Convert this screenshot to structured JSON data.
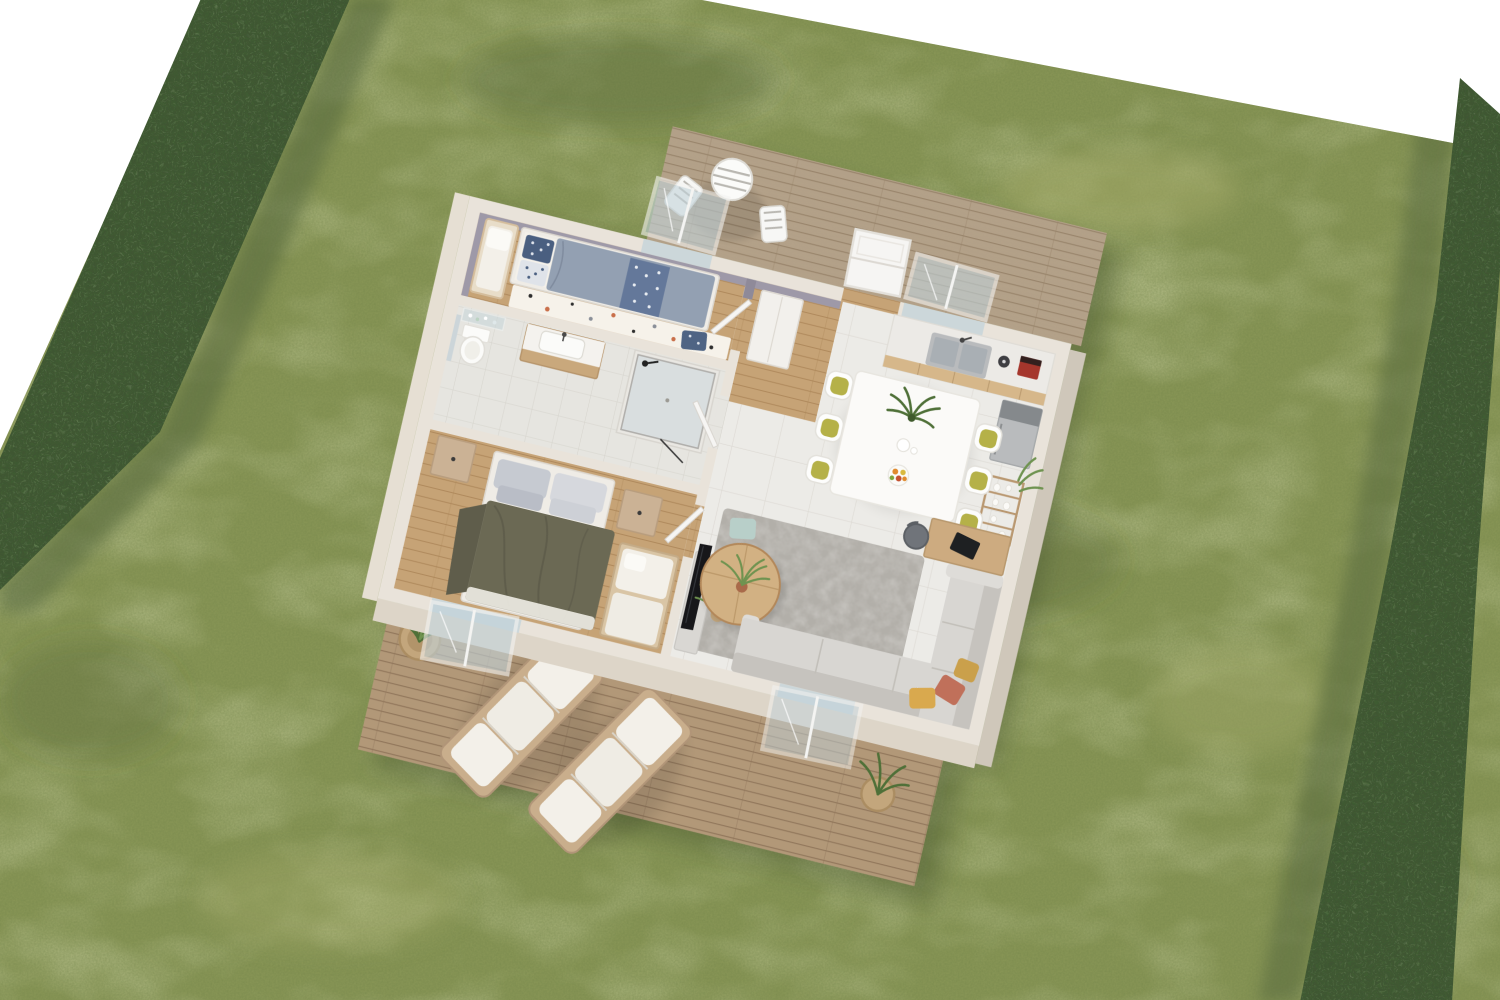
{
  "scene": {
    "title": "3D aerial cutaway floor plan of a small one-storey house",
    "view": "isometric top-down architectural render, no roof",
    "setting": "rectangular mowed lawn bordered by tall clipped hedges on a white studio background"
  },
  "colors": {
    "background": "#ffffff",
    "grass": "#8a9757",
    "grass_light": "#aab573",
    "grass_dark": "#3f5030",
    "hedge": "#3f5334",
    "hedge_dark": "#22301a",
    "hedge_light": "#5d7747",
    "deck_upper": "#b3a189",
    "deck_upper_gap": "#97836a",
    "deck_lower": "#b29878",
    "deck_lower_gap": "#8f7459",
    "wood_floor": "#c6a376",
    "wood_floor_gap": "#aa8557",
    "tile": "#ecebe7",
    "tile_line": "#dcd9d3",
    "bath_tile": "#e6e5e0",
    "bath_tile_line": "#d5d3cc",
    "wall_top": "#e9e3da",
    "wall_face": "#ddd5c8",
    "wall_face_dark": "#cfc7ba",
    "accent_wall": "#9e99a8",
    "accent_wall_dark": "#8f8a99",
    "bed_frame": "#efece6",
    "duvet_single": "#93a0b2",
    "pillow_navy": "#4a5f80",
    "duvet_master": "#6b6954",
    "duvet_master_dark": "#5f5d4b",
    "nightstand": "#cbb295",
    "bench_wood": "#d9c5a5",
    "cushion_white": "#f3f0e9",
    "rug_bedroom": "#f6f2ea",
    "rug_living": "#b2afa9",
    "sofa": "#d8d6d2",
    "sofa_dark": "#c6c3be",
    "pillow_mustard": "#d9a94e",
    "pillow_terracotta": "#c0705a",
    "pillow_skyblue": "#b8cfc9",
    "coffee_table_wood": "#d2b183",
    "desk_wood": "#cdab80",
    "laptop": "#1e2022",
    "tv": "#17171a",
    "tv_console": "#d9d7d3",
    "counter": "#eceae6",
    "cabinet_wood": "#d6b78a",
    "steel": "#b9bbbd",
    "steel_dark": "#85898c",
    "sink_steel": "#a9afb4",
    "espresso_machine": "#a5362c",
    "dining_table": "#fbfaf8",
    "chair_shell": "#fdfdfc",
    "chair_seat": "#b5b148",
    "plant": "#4f7038",
    "plant_light": "#6f9350",
    "pot_terracotta": "#a96a4a",
    "basket": "#c3a67c",
    "glass": "#c2d3da",
    "frame_white": "#f4f4f2",
    "door_white": "#f6f5f3",
    "fixture_white": "#fbfbf9",
    "lounger_frame": "#c9ae8c",
    "shadow": "#2f3c22"
  },
  "garden": {
    "lawn": "mowed grass lawn",
    "hedge_left": "tall clipped hedge (left boundary)",
    "hedge_right": "tall clipped hedge (right boundary)"
  },
  "terraces": {
    "upper": {
      "name": "Breakfast terrace",
      "deck": "light timber decking",
      "furniture": [
        "round striped bistro table",
        "2 white folding chairs"
      ]
    },
    "lower": {
      "name": "Garden terrace",
      "deck": "timber decking",
      "furniture": [
        "2 timber sun loungers with white cushions",
        "woven basket planter with grass plant",
        "woven basket planter at sofa corner"
      ]
    }
  },
  "house": {
    "walls": "beige plastered walls shown cut away from above",
    "rooms": [
      {
        "id": "bedroom-1",
        "name": "Bedroom 1",
        "floor": "oak plank",
        "accent": "lavender-grey painted walls",
        "furniture": [
          "single bed with grey-blue duvet and navy patterned pillows",
          "bench seat with white cushion",
          "white terrazzo-dot rug",
          "navy floor cushion",
          "double casement window to terrace"
        ]
      },
      {
        "id": "bathroom",
        "name": "Bathroom",
        "floor": "pale ceramic tile",
        "furniture": [
          "walk-in glass shower with black fittings",
          "timber vanity with white basin",
          "wall mirror",
          "glass shelves with toiletries",
          "toilet"
        ]
      },
      {
        "id": "bedroom-2",
        "name": "Master Bedroom",
        "floor": "oak plank",
        "furniture": [
          "double bed with olive-green throw and grey pillows",
          "2 timber nightstands",
          "timber bench with white cushions",
          "window onto garden terrace"
        ]
      },
      {
        "id": "hall",
        "name": "Entry Hall",
        "floor": "oak plank",
        "furniture": [
          "white wardrobe",
          "white front door"
        ]
      },
      {
        "id": "kitchen",
        "name": "Kitchen",
        "floor": "large-format tile",
        "furniture": [
          "counter with double stainless sink",
          "window over sink",
          "red espresso machine",
          "dark kettle",
          "stainless fridge-freezer",
          "ladder shelf with white vases and plant"
        ]
      },
      {
        "id": "dining",
        "name": "Dining Area",
        "floor": "large-format tile",
        "furniture": [
          "white dining table",
          "6 chairs with olive-yellow seat pads",
          "potted plant centerpiece",
          "fruit bowl",
          "white jug"
        ]
      },
      {
        "id": "living",
        "name": "Living Room",
        "floor": "large-format tile",
        "furniture": [
          "L-shaped grey sofa",
          "mustard and terracotta cushions",
          "round timber coffee table with plant in terracotta pot",
          "mottled grey rug",
          "sage floor cushion",
          "black TV on white media unit",
          "desk with laptop and grey chair",
          "leafy potted plant",
          "sliding glass door to terrace"
        ]
      }
    ]
  }
}
